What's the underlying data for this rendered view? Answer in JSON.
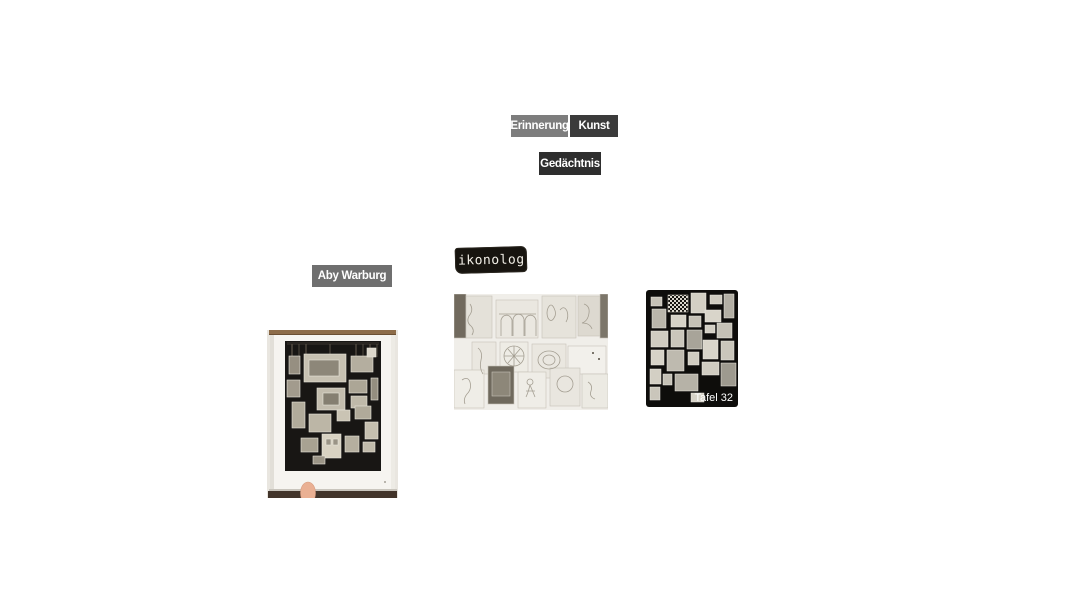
{
  "canvas": {
    "background": "#ffffff"
  },
  "nodes": {
    "erinnerung": {
      "label": "Erinnerung",
      "bg": "#7d7d7d",
      "color": "#ffffff"
    },
    "kunst": {
      "label": "Kunst",
      "bg": "#3b3b3b",
      "color": "#ffffff"
    },
    "gedaechtnis": {
      "label": "Gedächtnis",
      "bg": "#2e2e2e",
      "color": "#ffffff"
    },
    "aby_warburg": {
      "label": "Aby Warburg",
      "bg": "#6f6f6f",
      "color": "#ffffff"
    }
  },
  "images": {
    "ikonolog": {
      "text": "ikonolog",
      "bg": "#17140f",
      "color": "#f1eee6"
    },
    "book_photo": {
      "description": "photo of a book page with a black Mnemosyne-Atlas picture panel, held up by a fingertip"
    },
    "sketch_collage": {
      "description": "pale pencil-sketch collage of pictures arranged on a panel"
    },
    "tafel_32": {
      "caption": "Tafel 32",
      "description": "black-and-white photo of Atlas panel 32: small pictures pinned on a black cloth"
    }
  }
}
